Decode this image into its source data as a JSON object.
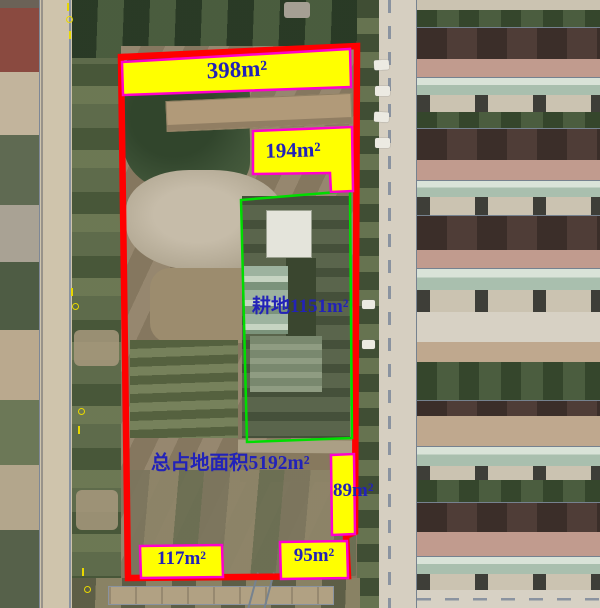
{
  "map": {
    "kind": "aerial-photo-with-parcel-annotations",
    "annotations": [
      {
        "id": "north-strip",
        "text": "398m²",
        "style": "yellow-box"
      },
      {
        "id": "inner-strip",
        "text": "194m²",
        "style": "yellow-box"
      },
      {
        "id": "farmland",
        "text": "耕地1151m²",
        "style": "green-outline"
      },
      {
        "id": "total-area",
        "text": "总占地面积5192m²",
        "style": "text-only"
      },
      {
        "id": "east-strip",
        "text": "89m²",
        "style": "yellow-box"
      },
      {
        "id": "south-west-strip",
        "text": "117m²",
        "style": "yellow-box"
      },
      {
        "id": "south-east-strip",
        "text": "95m²",
        "style": "yellow-box"
      }
    ],
    "measurements": {
      "north_strip_m2": 398,
      "inner_strip_m2": 194,
      "farmland_m2": 1151,
      "total_site_m2": 5192,
      "east_strip_m2": 89,
      "south_west_strip_m2": 117,
      "south_east_strip_m2": 95
    },
    "colors": {
      "parcel_boundary": "#ff0000",
      "farmland_boundary": "#00dd00",
      "label_fill": "#ffff00",
      "label_border": "#ff00cc",
      "label_text": "#2222b8",
      "none": "none"
    }
  }
}
